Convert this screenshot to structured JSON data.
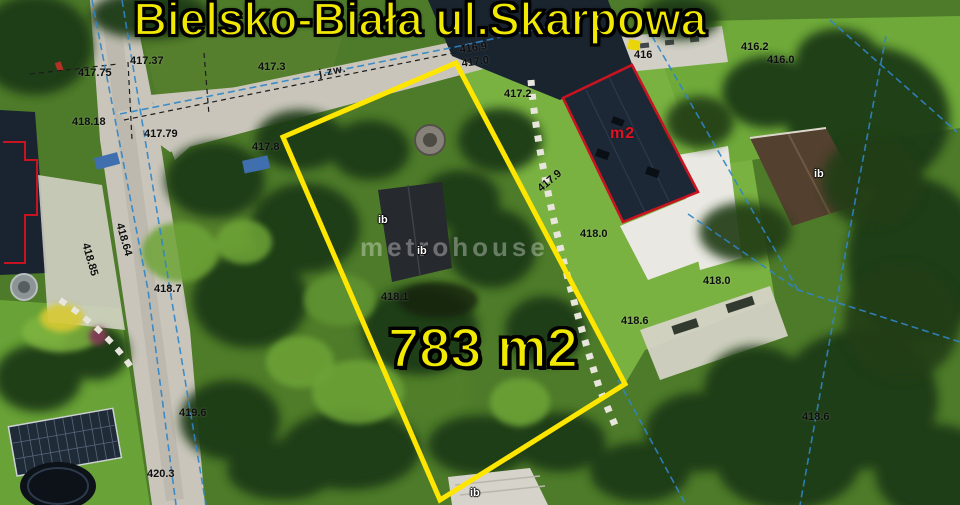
{
  "title": "Bielsko-Biała ul.Skarpowa",
  "plot": {
    "area_label": "783 m2",
    "outline_color": "#ffe600"
  },
  "marked_building": {
    "label": "m2",
    "outline_color": "#c81420"
  },
  "watermark": "metrohouse",
  "road_class_label": "j.zw.",
  "building_labels": [
    "ib",
    "ib",
    "ib",
    "ib"
  ],
  "elevation_points": [
    "417.75",
    "417.37",
    "417.3",
    "418.18",
    "417.79",
    "417.8",
    "416.9",
    "417.0",
    "417.2",
    "416",
    "416.2",
    "416.0",
    "417.9",
    "418.0",
    "418.0",
    "418.6",
    "418.64",
    "418.85",
    "418.7",
    "418.1",
    "419.6",
    "420.3",
    "418.6"
  ],
  "colors": {
    "title_text": "#f2e900",
    "area_text": "#f2e900",
    "plot_outline": "#ffe600",
    "building_outline": "#c81420",
    "cadastral_line": "#2f85c8",
    "elevation_text": "#0e0e0e"
  }
}
